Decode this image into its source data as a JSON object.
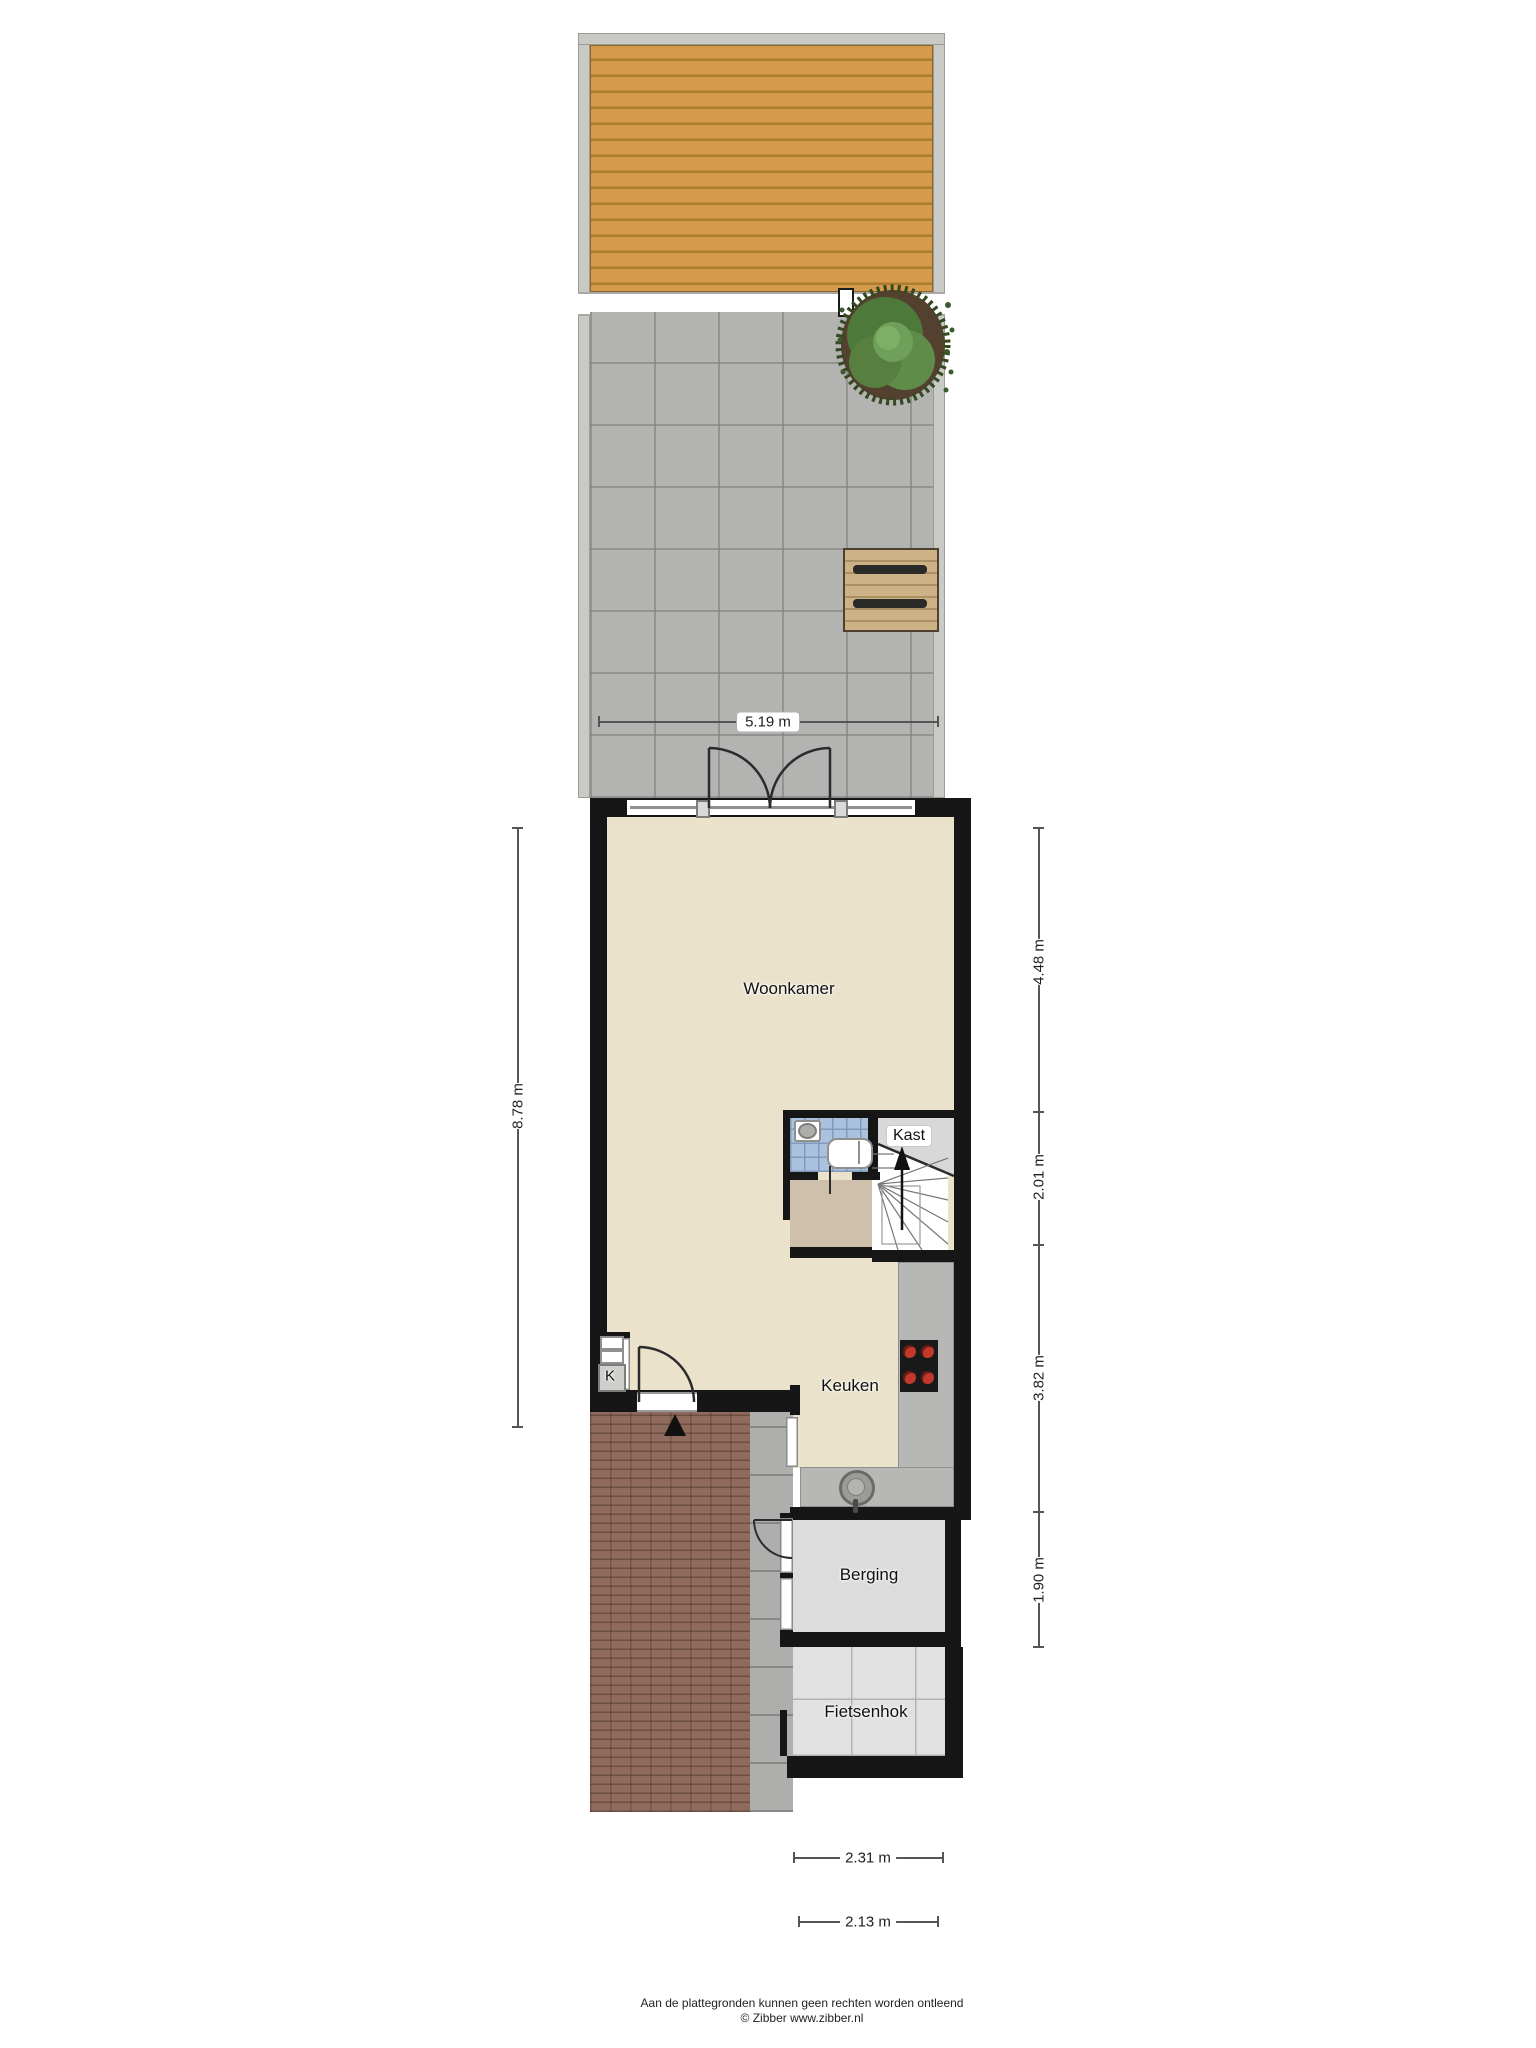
{
  "labels": {
    "woonkamer": "Woonkamer",
    "kast": "Kast",
    "keuken": "Keuken",
    "berging": "Berging",
    "fietsenhok": "Fietsenhok",
    "meterkast": "K"
  },
  "dims": {
    "garden_width": "5.19 m",
    "house_depth": "8.78 m",
    "seg1": "4.48 m",
    "seg2": "2.01 m",
    "seg3": "3.82 m",
    "seg4": "1.90 m",
    "berging_width": "2.31 m",
    "fietsenhok_width": "2.13 m"
  },
  "footer": {
    "disclaimer": "Aan de plattegronden kunnen geen rechten worden ontleend",
    "copyright": "© Zibber www.zibber.nl"
  },
  "icons": {
    "entrance_arrow": "entrance-direction-arrow",
    "stairs_arrow": "stairs-up-arrow",
    "plant": "garden-shrub",
    "picnic_table": "garden-bench-table"
  },
  "colors": {
    "deck_wood": "#d69a4c",
    "patio_tile": "#b3b3b1",
    "wall": "#161616",
    "floor_living": "#eae2cb",
    "floor_hall": "#cfc0ab",
    "bathroom_blue": "#abc2de",
    "counter_gray": "#b7b7b5",
    "berging_gray": "#dcdcdc",
    "brick": "#8e6b5c",
    "plant_green": "#4d7a3a",
    "burner_red": "#c0392b"
  }
}
